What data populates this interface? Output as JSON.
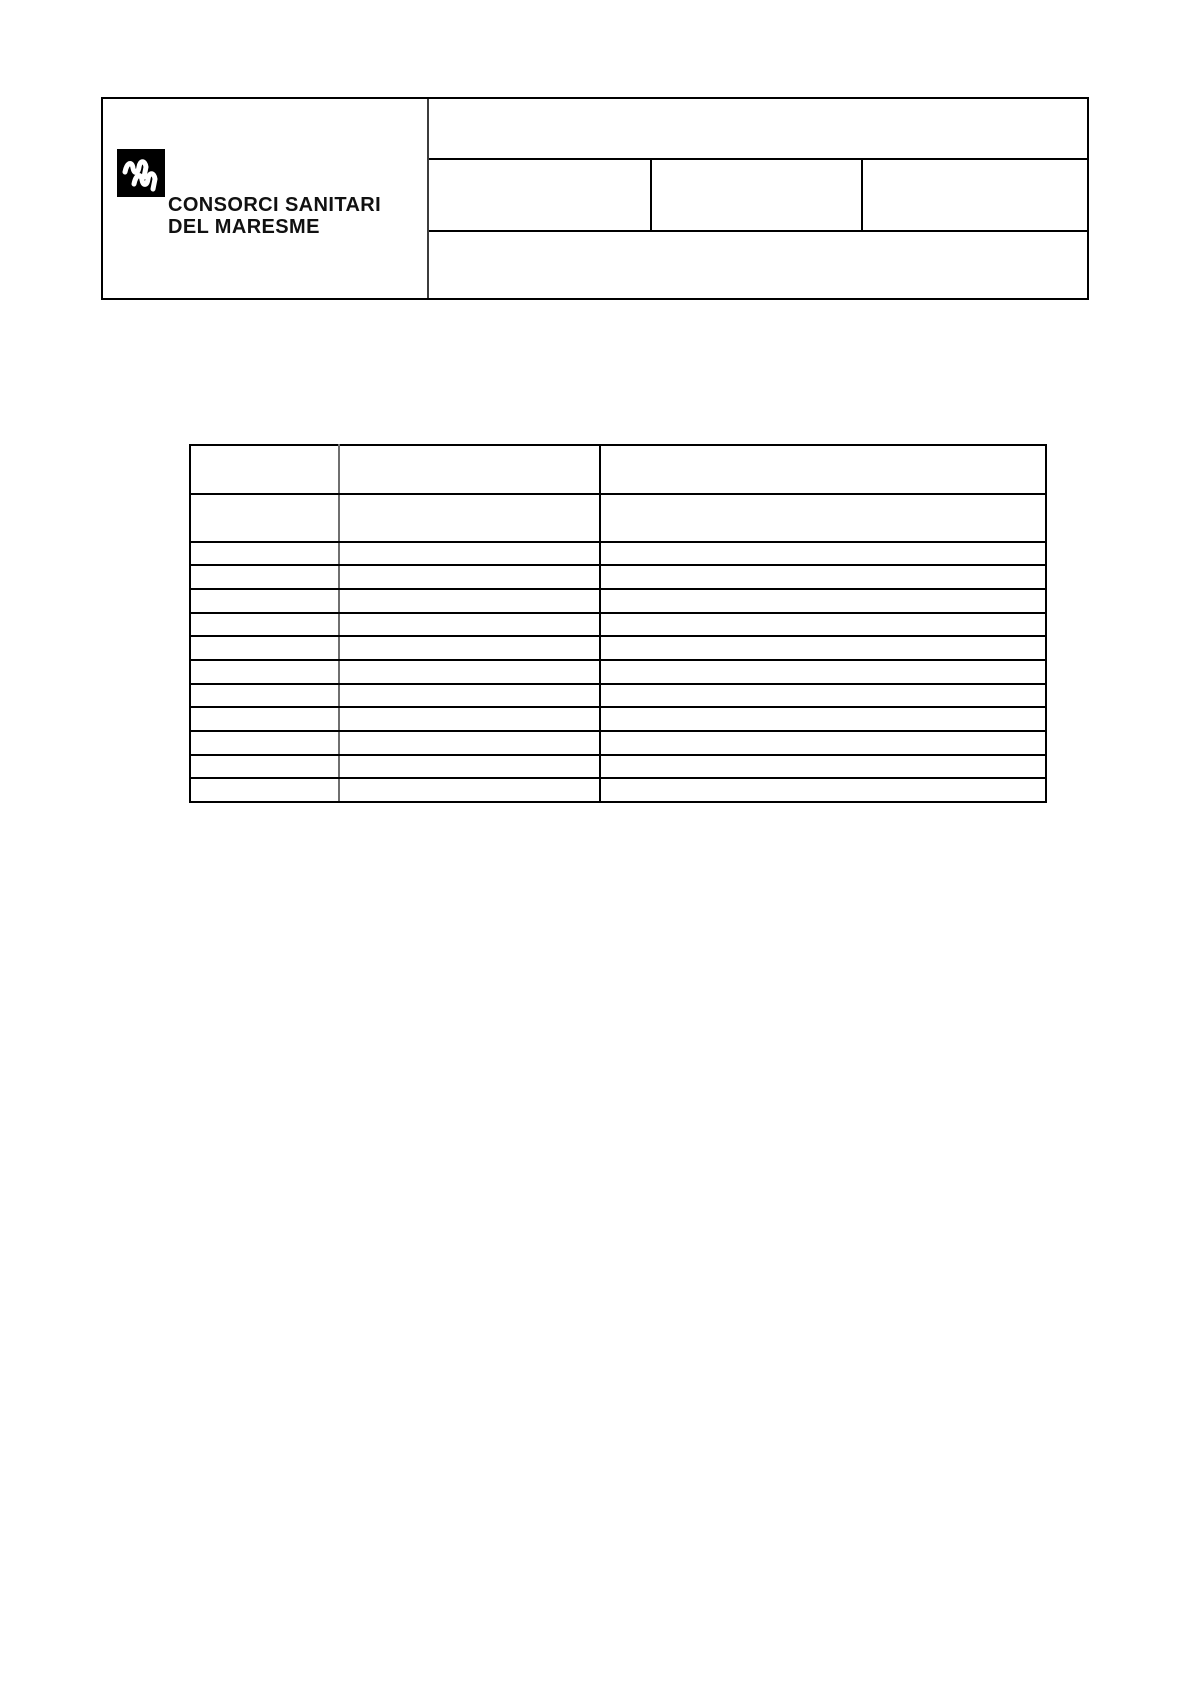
{
  "page": {
    "background": "#ffffff",
    "kind": "blank-form-document"
  },
  "org": {
    "name_line1": "CONSORCI SANITARI",
    "name_line2": "DEL MARESME",
    "logo_color": "#000000",
    "logo_glyph": "double-wave-m-icon"
  },
  "header_box": {
    "left_cell_content": "",
    "right_top_cell": "",
    "right_middle_cells": [
      "",
      "",
      ""
    ],
    "right_bottom_cell": ""
  },
  "main_table": {
    "header_row": [
      "",
      "",
      ""
    ],
    "subheader_row": [
      "",
      "",
      ""
    ],
    "body_rows": [
      [
        "",
        "",
        ""
      ],
      [
        "",
        "",
        ""
      ],
      [
        "",
        "",
        ""
      ],
      [
        "",
        "",
        ""
      ],
      [
        "",
        "",
        ""
      ],
      [
        "",
        "",
        ""
      ],
      [
        "",
        "",
        ""
      ],
      [
        "",
        "",
        ""
      ],
      [
        "",
        "",
        ""
      ],
      [
        "",
        "",
        ""
      ],
      [
        "",
        "",
        ""
      ]
    ]
  },
  "colors": {
    "border": "#000000",
    "light_divider": "#6f6f6f",
    "text": "#111111"
  }
}
